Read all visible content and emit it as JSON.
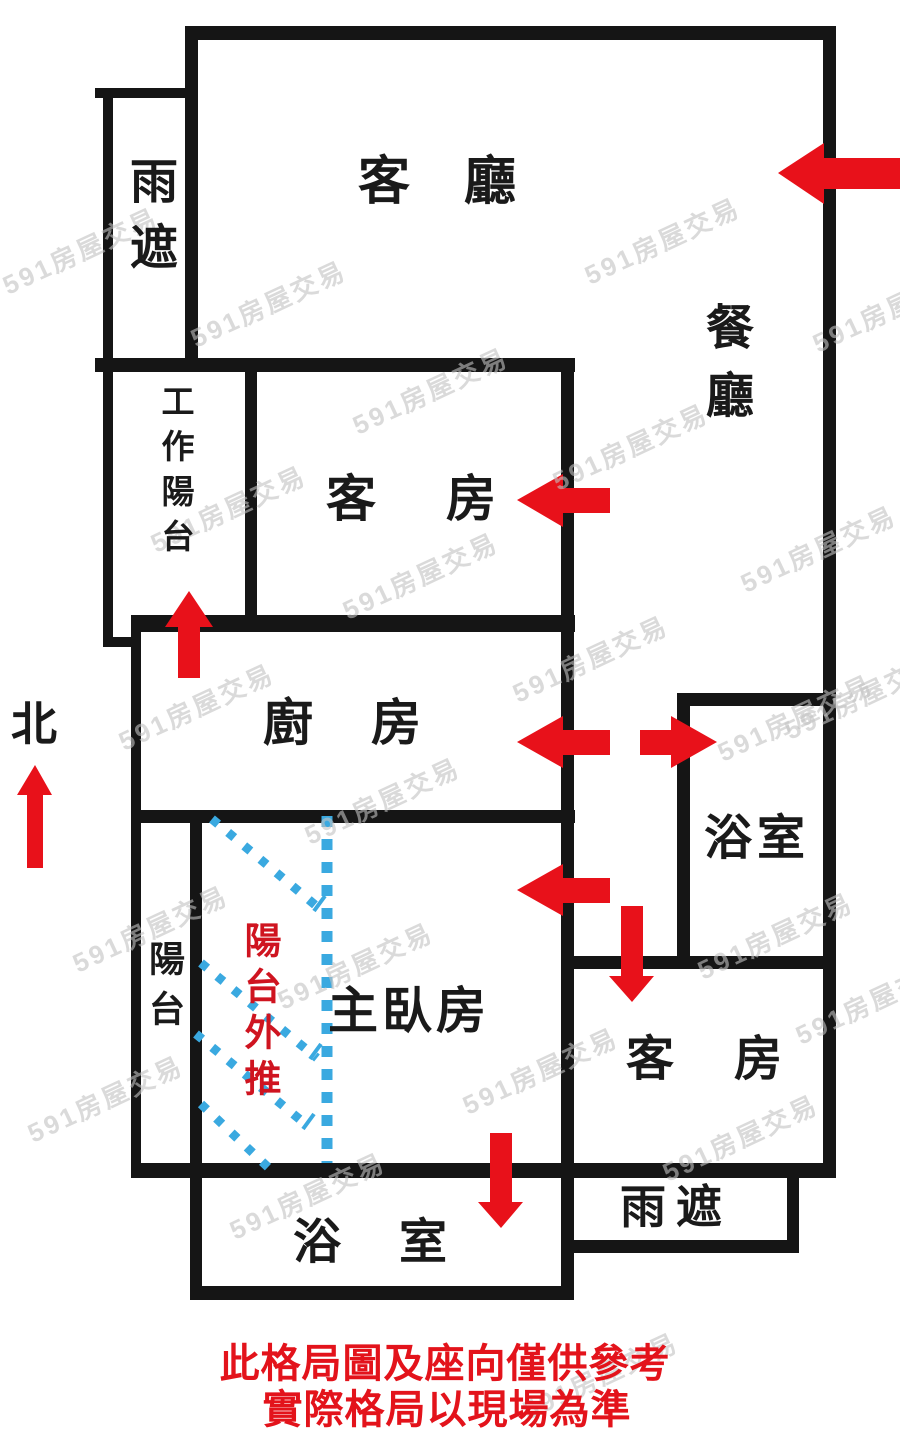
{
  "colors": {
    "bg": "#ffffff",
    "wall": "#151515",
    "text_black": "#1a1a1a",
    "arrow_red": "#e8111a",
    "annotation_blue": "#3aa9e0",
    "pushout_red": "#cf1420",
    "disclaimer_red": "#e3131b",
    "watermark_gray": "#c3c3c3"
  },
  "compass": {
    "north_label": "北"
  },
  "rooms": {
    "living_room": {
      "label": "客廳"
    },
    "dining_room": {
      "label": "餐廳"
    },
    "rain_shelter_top": {
      "label": "雨遮"
    },
    "work_balcony": {
      "label": "工作陽台"
    },
    "guest_room_top": {
      "label": "客房"
    },
    "kitchen": {
      "label": "廚房"
    },
    "bathroom_right": {
      "label": "浴室"
    },
    "balcony": {
      "label": "陽台"
    },
    "master_bedroom": {
      "label": "主臥房"
    },
    "guest_room_bottom": {
      "label": "客房"
    },
    "bathroom_bottom": {
      "label": "浴室"
    },
    "rain_shelter_bottom": {
      "label": "雨遮"
    }
  },
  "annotations": {
    "balcony_pushout": "陽台外推",
    "watermark": "591房屋交易"
  },
  "disclaimer": {
    "line1": "此格局圖及座向僅供參考",
    "line2": "實際格局以現場為準"
  },
  "arrows": [
    {
      "name": "entry-arrow-dining",
      "direction": "left"
    },
    {
      "name": "arrow-guest-room-top",
      "direction": "left"
    },
    {
      "name": "arrow-work-balcony",
      "direction": "up"
    },
    {
      "name": "arrow-kitchen",
      "direction": "left"
    },
    {
      "name": "arrow-bathroom-right",
      "direction": "right"
    },
    {
      "name": "arrow-master-bedroom",
      "direction": "left"
    },
    {
      "name": "arrow-guest-room-bottom",
      "direction": "down"
    },
    {
      "name": "arrow-bathroom-bottom",
      "direction": "down"
    },
    {
      "name": "compass-north-arrow",
      "direction": "up"
    }
  ]
}
